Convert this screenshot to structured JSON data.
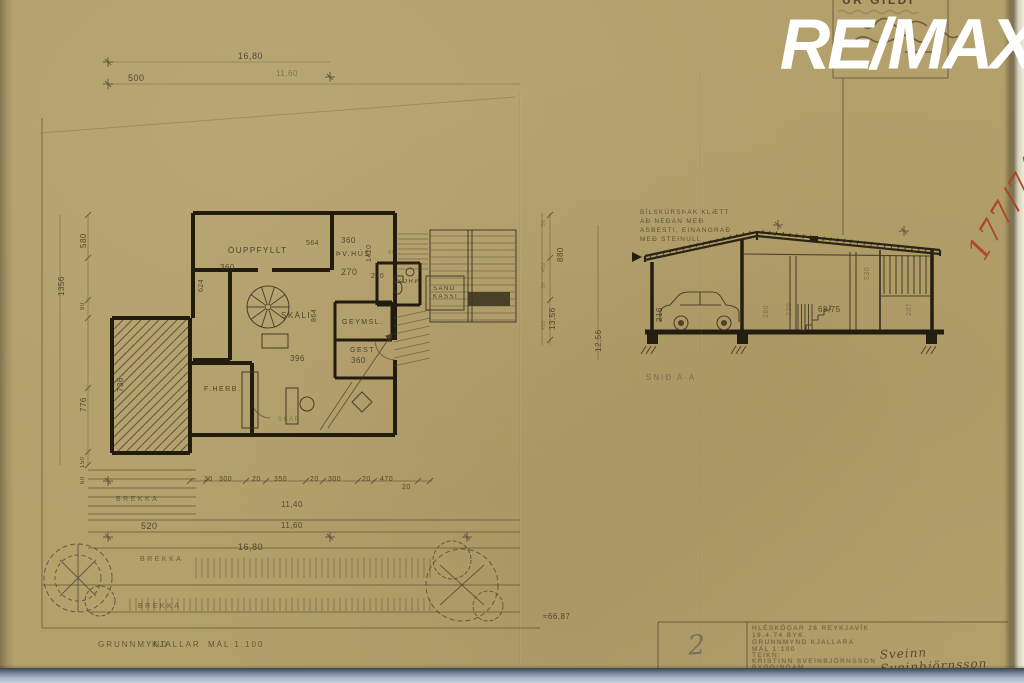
{
  "meta": {
    "paper_color": "#b3a06b",
    "ink_color": "#3b3220",
    "red_color": "#aa4526",
    "watermark_color": "#ffffff"
  },
  "watermark": {
    "text": "RE/MAX"
  },
  "stamp": {
    "heading": "ÚR GILDI"
  },
  "red_note": {
    "text": "177/74"
  },
  "plan": {
    "caption": "GRUNNMYND KJALLAR",
    "scale_label": "MÁL 1:100"
  },
  "section": {
    "caption": "SNIÐ A-A"
  },
  "titleblock": {
    "sheet_number": "2",
    "signature": "Sveinn Sveinbjörnsson",
    "typed_lines": [
      {
        "t": "HLÉSKÓGAR 26 REYKJAVÍK",
        "x": 752,
        "y": 626
      },
      {
        "t": "19.4.74      BYK.",
        "x": 752,
        "y": 633
      },
      {
        "t": "GRUNNMYND  KJALLARA",
        "x": 752,
        "y": 640
      },
      {
        "t": "MÁL   1:100",
        "x": 752,
        "y": 647
      },
      {
        "t": "TEIKN:",
        "x": 752,
        "y": 653
      },
      {
        "t": "KRISTINN  SVEINBJÖRNSSON",
        "x": 752,
        "y": 659
      },
      {
        "t": "BYGGINGAM.",
        "x": 752,
        "y": 665
      }
    ]
  },
  "labels": [
    {
      "t": "500",
      "x": 128,
      "y": 74,
      "s": 9,
      "cls": "dim",
      "n": "site-dim-500"
    },
    {
      "t": "16,80",
      "x": 238,
      "y": 52,
      "s": 9,
      "cls": "dim",
      "n": "site-dim-1680-top"
    },
    {
      "t": "11,60",
      "x": 276,
      "y": 70,
      "s": 8,
      "cls": "dim faint"
    },
    {
      "t": "ÓUPPFYLLT",
      "x": 228,
      "y": 247,
      "s": 8,
      "cls": "room",
      "n": "room-ouppfyllt"
    },
    {
      "t": "360",
      "x": 220,
      "y": 264,
      "s": 8,
      "cls": "dim"
    },
    {
      "t": "624",
      "x": 198,
      "y": 292,
      "s": 7,
      "cls": "dim",
      "r": -90
    },
    {
      "t": "564",
      "x": 306,
      "y": 240,
      "s": 7,
      "cls": "dim"
    },
    {
      "t": "360",
      "x": 341,
      "y": 237,
      "s": 8,
      "cls": "dim"
    },
    {
      "t": "1420",
      "x": 366,
      "y": 262,
      "s": 7,
      "cls": "dim",
      "r": -90
    },
    {
      "t": "ÞV.HÚS",
      "x": 336,
      "y": 251,
      "s": 7,
      "cls": "room",
      "n": "room-thvhus"
    },
    {
      "t": "270",
      "x": 341,
      "y": 268,
      "s": 9,
      "cls": "dim"
    },
    {
      "t": "210",
      "x": 371,
      "y": 273,
      "s": 7,
      "cls": "dim"
    },
    {
      "t": "90",
      "x": 388,
      "y": 250,
      "s": 6,
      "cls": "dim faint"
    },
    {
      "t": "SKÁLI",
      "x": 281,
      "y": 312,
      "s": 8,
      "cls": "room",
      "n": "room-skali"
    },
    {
      "t": "864",
      "x": 311,
      "y": 322,
      "s": 7,
      "cls": "dim",
      "r": -90
    },
    {
      "t": "396",
      "x": 290,
      "y": 355,
      "s": 8,
      "cls": "dim"
    },
    {
      "t": "GEYMSL.",
      "x": 342,
      "y": 319,
      "s": 7,
      "cls": "room",
      "n": "room-geymsl"
    },
    {
      "t": "GEST",
      "x": 350,
      "y": 347,
      "s": 7,
      "cls": "room",
      "n": "room-gest"
    },
    {
      "t": "360",
      "x": 351,
      "y": 357,
      "s": 8,
      "cls": "dim"
    },
    {
      "t": "736",
      "x": 117,
      "y": 392,
      "s": 8,
      "cls": "dim",
      "r": -90
    },
    {
      "t": "F.HERB.",
      "x": 204,
      "y": 386,
      "s": 7,
      "cls": "room",
      "n": "room-fherb"
    },
    {
      "t": "SKÁP",
      "x": 278,
      "y": 417,
      "s": 6,
      "cls": "room faint"
    },
    {
      "t": "SORP",
      "x": 397,
      "y": 279,
      "s": 6,
      "cls": "room"
    },
    {
      "t": "SAND",
      "x": 433,
      "y": 286,
      "s": 6,
      "cls": "room"
    },
    {
      "t": "KASSI",
      "x": 433,
      "y": 294,
      "s": 6,
      "cls": "room"
    },
    {
      "t": "1356",
      "x": 58,
      "y": 296,
      "s": 8,
      "cls": "dim",
      "r": -90
    },
    {
      "t": "580",
      "x": 80,
      "y": 248,
      "s": 8,
      "cls": "dim",
      "r": -90
    },
    {
      "t": "90",
      "x": 80,
      "y": 310,
      "s": 6,
      "cls": "dim",
      "r": -90
    },
    {
      "t": "776",
      "x": 80,
      "y": 412,
      "s": 8,
      "cls": "dim",
      "r": -90
    },
    {
      "t": "150",
      "x": 80,
      "y": 468,
      "s": 6,
      "cls": "dim",
      "r": -90
    },
    {
      "t": "60",
      "x": 80,
      "y": 484,
      "s": 6,
      "cls": "dim",
      "r": -90
    },
    {
      "t": "880",
      "x": 557,
      "y": 262,
      "s": 8,
      "cls": "dim",
      "r": -90
    },
    {
      "t": "56",
      "x": 542,
      "y": 226,
      "s": 5,
      "cls": "dim faint",
      "r": -90
    },
    {
      "t": "450",
      "x": 542,
      "y": 272,
      "s": 5,
      "cls": "dim faint",
      "r": -90
    },
    {
      "t": "56",
      "x": 542,
      "y": 288,
      "s": 5,
      "cls": "dim faint",
      "r": -90
    },
    {
      "t": "450",
      "x": 542,
      "y": 330,
      "s": 5,
      "cls": "dim faint",
      "r": -90
    },
    {
      "t": "13,56",
      "x": 549,
      "y": 330,
      "s": 8,
      "cls": "dim",
      "r": -90
    },
    {
      "t": "12,56",
      "x": 595,
      "y": 352,
      "s": 8,
      "cls": "dim",
      "r": -90
    },
    {
      "t": "30",
      "x": 204,
      "y": 476,
      "s": 7,
      "cls": "dim"
    },
    {
      "t": "300",
      "x": 219,
      "y": 476,
      "s": 7,
      "cls": "dim"
    },
    {
      "t": "20",
      "x": 252,
      "y": 476,
      "s": 7,
      "cls": "dim"
    },
    {
      "t": "350",
      "x": 274,
      "y": 476,
      "s": 7,
      "cls": "dim"
    },
    {
      "t": "20",
      "x": 310,
      "y": 476,
      "s": 7,
      "cls": "dim"
    },
    {
      "t": "300",
      "x": 328,
      "y": 476,
      "s": 7,
      "cls": "dim"
    },
    {
      "t": "20",
      "x": 362,
      "y": 476,
      "s": 7,
      "cls": "dim"
    },
    {
      "t": "470",
      "x": 380,
      "y": 476,
      "s": 7,
      "cls": "dim"
    },
    {
      "t": "20",
      "x": 402,
      "y": 484,
      "s": 7,
      "cls": "dim"
    },
    {
      "t": "11,40",
      "x": 281,
      "y": 501,
      "s": 8,
      "cls": "dim"
    },
    {
      "t": "520",
      "x": 141,
      "y": 522,
      "s": 9,
      "cls": "dim",
      "n": "site-dim-520"
    },
    {
      "t": "11,60",
      "x": 281,
      "y": 522,
      "s": 8,
      "cls": "dim"
    },
    {
      "t": "16,80",
      "x": 238,
      "y": 543,
      "s": 9,
      "cls": "dim",
      "n": "site-dim-1680-bottom"
    },
    {
      "t": "BREKKA",
      "x": 116,
      "y": 496,
      "s": 7,
      "cls": "slope",
      "n": "slope-brekka-1"
    },
    {
      "t": "BREKKA",
      "x": 140,
      "y": 556,
      "s": 7,
      "cls": "slope",
      "n": "slope-brekka-2"
    },
    {
      "t": "BREKKA",
      "x": 138,
      "y": 603,
      "s": 7,
      "cls": "slope",
      "n": "slope-brekka-3"
    },
    {
      "t": "≈66,87",
      "x": 543,
      "y": 613,
      "s": 8,
      "cls": "dim"
    },
    {
      "t": "GRUNNMYND",
      "x": 98,
      "y": 641,
      "s": 8,
      "cls": "caption",
      "n": "plan-caption"
    },
    {
      "t": "KJALLAR",
      "x": 152,
      "y": 641,
      "s": 8,
      "cls": "caption"
    },
    {
      "t": "MÁL 1:100",
      "x": 208,
      "y": 641,
      "s": 8,
      "cls": "caption",
      "n": "plan-scale"
    },
    {
      "t": "BÍLSKÚRSÞAK KLÆTT",
      "x": 640,
      "y": 210,
      "s": 6.5,
      "cls": "note",
      "n": "section-note-1"
    },
    {
      "t": "AÐ NEÐAN MEÐ",
      "x": 640,
      "y": 219,
      "s": 6.5,
      "cls": "note",
      "n": "section-note-2"
    },
    {
      "t": "ASBESTI, EINANGRAÐ",
      "x": 640,
      "y": 228,
      "s": 6.5,
      "cls": "note",
      "n": "section-note-3"
    },
    {
      "t": "MEÐ STEINULL",
      "x": 640,
      "y": 237,
      "s": 6.5,
      "cls": "note",
      "n": "section-note-4"
    },
    {
      "t": "216",
      "x": 656,
      "y": 322,
      "s": 8,
      "cls": "dim",
      "r": -90,
      "n": "section-dim-216"
    },
    {
      "t": "280",
      "x": 763,
      "y": 318,
      "s": 7,
      "cls": "dim faint",
      "r": -90
    },
    {
      "t": "220",
      "x": 786,
      "y": 316,
      "s": 7,
      "cls": "dim faint",
      "r": -90
    },
    {
      "t": "530",
      "x": 864,
      "y": 280,
      "s": 7,
      "cls": "dim faint",
      "r": -90
    },
    {
      "t": "207",
      "x": 906,
      "y": 316,
      "s": 7,
      "cls": "dim faint",
      "r": -90
    },
    {
      "t": "68,75",
      "x": 818,
      "y": 306,
      "s": 8,
      "cls": "dim",
      "n": "section-dim-6875"
    },
    {
      "t": "SNIÐ A-A",
      "x": 646,
      "y": 374,
      "s": 8,
      "cls": "caption faint",
      "n": "section-caption"
    }
  ]
}
